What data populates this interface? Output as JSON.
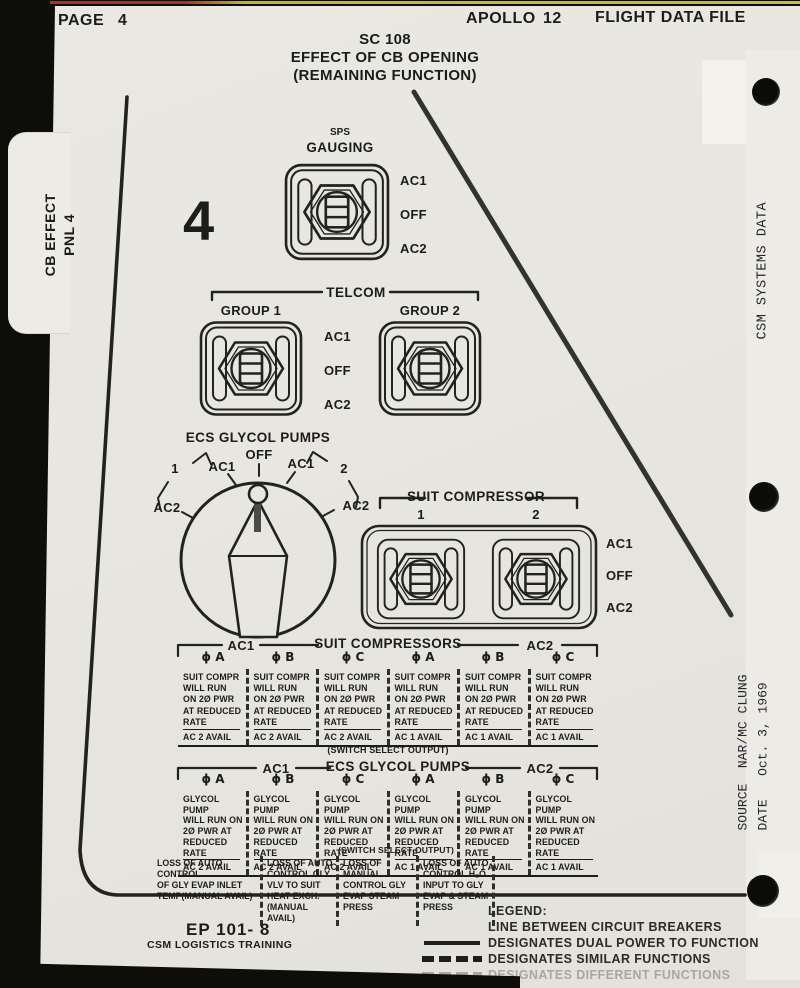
{
  "header": {
    "page_label": "PAGE",
    "page_number": "4",
    "program": "APOLLO",
    "mission": "12",
    "doc_title": "FLIGHT DATA FILE"
  },
  "title": {
    "spacecraft": "SC 108",
    "line1": "EFFECT OF CB OPENING",
    "line2": "(REMAINING FUNCTION)"
  },
  "panel_number": "4",
  "side_tab": {
    "label": "CB EFFECT\nPNL 4"
  },
  "right_margin": {
    "section": "CSM SYSTEMS DATA",
    "source_stamp": "SOURCE  NAR/MC CLUNG\nDATE   Oct. 3, 1969"
  },
  "sps_switch": {
    "system": "SPS",
    "name": "GAUGING",
    "positions": [
      "AC1",
      "OFF",
      "AC2"
    ]
  },
  "telcom": {
    "title": "TELCOM",
    "group1": "GROUP 1",
    "group2": "GROUP 2",
    "positions": [
      "AC1",
      "OFF",
      "AC2"
    ]
  },
  "glycol_dial": {
    "title": "ECS GLYCOL PUMPS",
    "off": "OFF",
    "ac1_left": "AC1",
    "ac1_right": "AC1",
    "ac2_left": "AC2",
    "ac2_right": "AC2",
    "group_left": "1",
    "group_right": "2"
  },
  "suit_compressor": {
    "title": "SUIT COMPRESSOR",
    "switch1": "1",
    "switch2": "2",
    "positions": [
      "AC1",
      "OFF",
      "AC2"
    ]
  },
  "suit_table": {
    "bus_left": "AC1",
    "title": "SUIT COMPRESSORS",
    "bus_right": "AC2",
    "phases": [
      "ϕ A",
      "ϕ B",
      "ϕ C",
      "ϕ A",
      "ϕ B",
      "ϕ C"
    ],
    "cells": [
      {
        "body": "SUIT COMPR\nWILL RUN\nON 2Ø PWR\nAT REDUCED",
        "underline": "RATE",
        "avail": "AC 2 AVAIL"
      },
      {
        "body": "SUIT COMPR\nWILL RUN\nON 2Ø PWR\nAT REDUCED",
        "underline": "RATE",
        "avail": "AC 2 AVAIL"
      },
      {
        "body": "SUIT COMPR\nWILL RUN\nON 2Ø PWR\nAT REDUCED",
        "underline": "RATE",
        "avail": "AC 2 AVAIL"
      },
      {
        "body": "SUIT COMPR\nWILL RUN\nON 2Ø PWR\nAT REDUCED",
        "underline": "RATE",
        "avail": "AC 1 AVAIL"
      },
      {
        "body": "SUIT COMPR\nWILL RUN\nON 2Ø PWR\nAT REDUCED",
        "underline": "RATE",
        "avail": "AC 1 AVAIL"
      },
      {
        "body": "SUIT COMPR\nWILL RUN\nON 2Ø PWR\nAT REDUCED",
        "underline": "RATE",
        "avail": "AC 1 AVAIL"
      }
    ]
  },
  "switch_select_note": "(SWITCH SELECT OUTPUT)",
  "glycol_table": {
    "bus_left": "AC1",
    "title": "ECS GLYCOL PUMPS",
    "bus_right": "AC2",
    "phases": [
      "ϕ A",
      "ϕ B",
      "ϕ C",
      "ϕ A",
      "ϕ B",
      "ϕ C"
    ],
    "cells": [
      {
        "body": "GLYCOL PUMP\nWILL RUN ON\n2Ø PWR AT",
        "underline": "REDUCED RATE",
        "avail": "AC 2 AVAIL"
      },
      {
        "body": "GLYCOL PUMP\nWILL RUN ON\n2Ø PWR AT",
        "underline": "REDUCED RATE",
        "avail": "AC 2 AVAIL"
      },
      {
        "body": "GLYCOL PUMP\nWILL RUN ON\n2Ø PWR AT",
        "underline": "REDUCED RATE",
        "avail": "AC 2 AVAIL"
      },
      {
        "body": "GLYCOL PUMP\nWILL RUN ON\n2Ø PWR AT",
        "underline": "REDUCED RATE",
        "avail": "AC 1 AVAIL"
      },
      {
        "body": "GLYCOL PUMP\nWILL RUN ON\n2Ø PWR AT",
        "underline": "REDUCED RATE",
        "avail": "AC 1 AVAIL"
      },
      {
        "body": "GLYCOL PUMP\nWILL RUN ON\n2Ø PWR AT",
        "underline": "REDUCED RATE",
        "avail": "AC 1 AVAIL"
      }
    ]
  },
  "loss_notes": [
    "LOSS OF AUTO CONTROL\nOF GLY EVAP INLET\nTEMP(MANUAL AVAIL)",
    "LOSS OF AUTO\nCONTROL GLY\nVLV TO SUIT\nHEAT EXCH.\n(MANUAL AVAIL)",
    "LOSS OF MANUAL\nCONTROL GLY\nEVAP STEAM\nPRESS",
    "LOSS OF AUTO\nCONTROL H₂O\nINPUT TO GLY\nEVAP & STEAM\nPRESS"
  ],
  "legend": {
    "title": "LEGEND:",
    "intro": "LINE BETWEEN CIRCUIT BREAKERS",
    "solid_label": "DESIGNATES DUAL POWER TO FUNCTION",
    "dashed_label": "DESIGNATES SIMILAR FUNCTIONS",
    "faded_label": "DESIGNATES DIFFERENT FUNCTIONS"
  },
  "footer": {
    "doc_id": "EP 101- 8",
    "org": "CSM LOGISTICS TRAINING"
  }
}
